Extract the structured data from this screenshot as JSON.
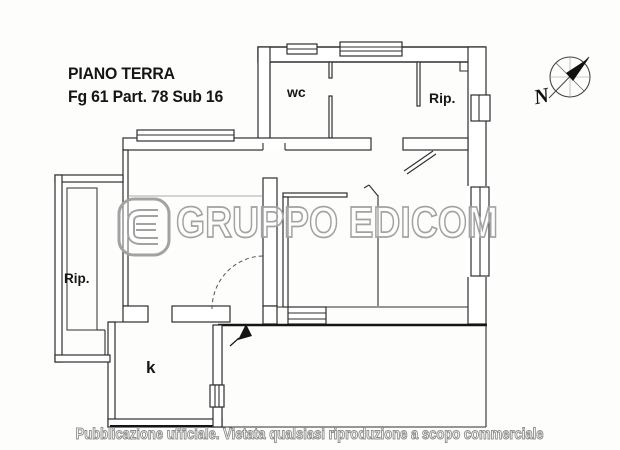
{
  "plan": {
    "title_line1": "PIANO TERRA",
    "title_line2": "Fg 61 Part. 78 Sub 16",
    "rooms": [
      {
        "key": "wc",
        "label": "wc"
      },
      {
        "key": "rip_top",
        "label": "Rip."
      },
      {
        "key": "rip_left",
        "label": "Rip."
      },
      {
        "key": "kitchen",
        "label": "k"
      }
    ]
  },
  "compass": {
    "north_label": "N"
  },
  "watermark": {
    "text": "GRUPPO EDICOM"
  },
  "footer": {
    "disclaimer": "Pubblicazione ufficiale. Vietata qualsiasi riproduzione a scopo commerciale"
  },
  "colors": {
    "wall": "#2e2e2e",
    "bold_line": "#151515",
    "watermark_outline": "#a2a2a2",
    "background": "#fdfdfc"
  }
}
